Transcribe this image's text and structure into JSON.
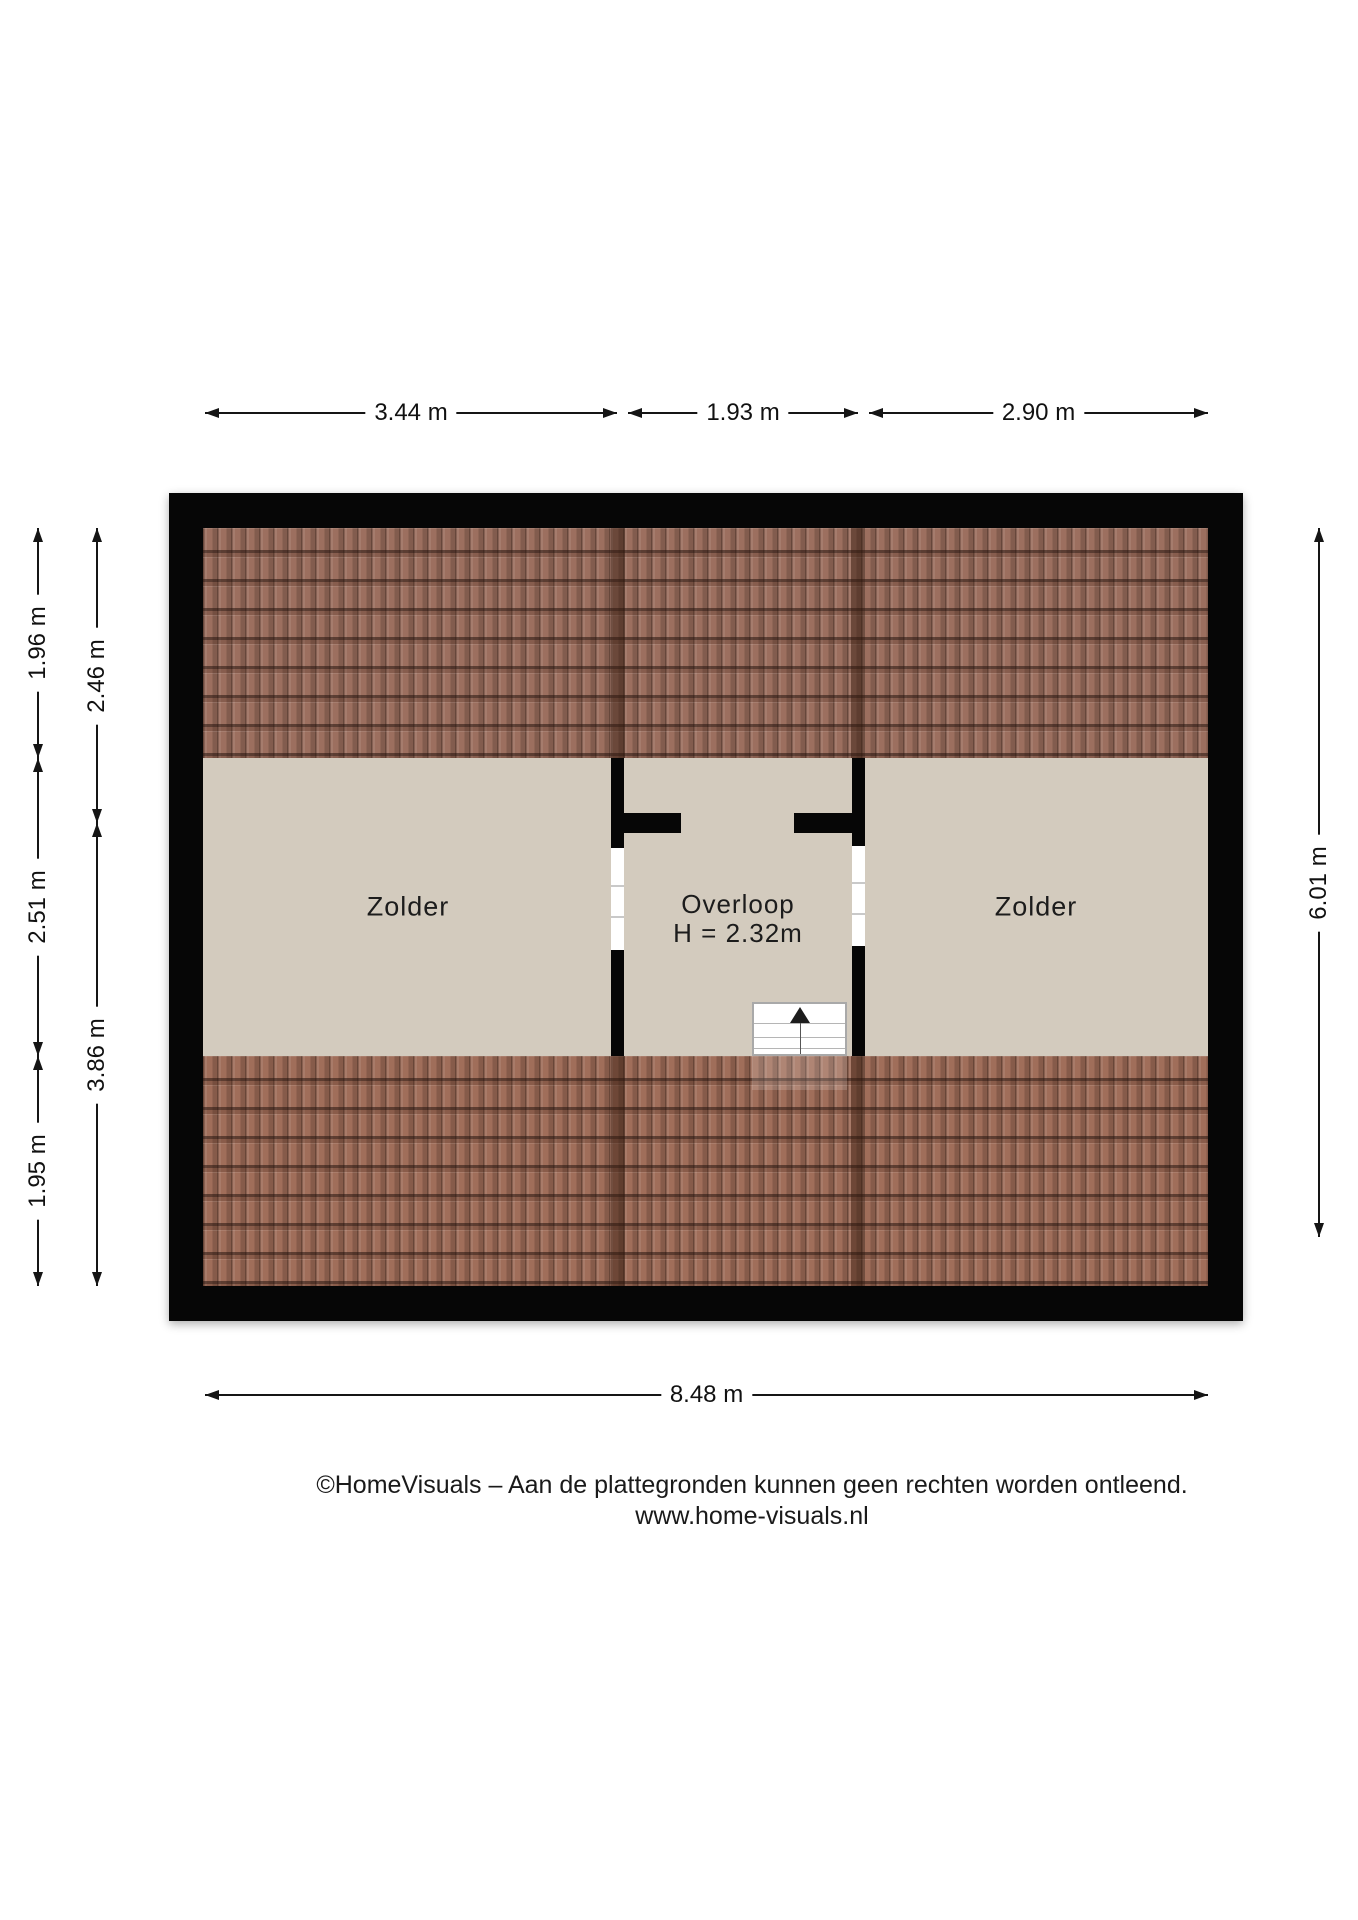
{
  "plan": {
    "type": "attic-floorplan",
    "rooms": {
      "zolder_left": {
        "label": "Zolder"
      },
      "overloop": {
        "label": "Overloop",
        "height_note": "H = 2.32m"
      },
      "zolder_right": {
        "label": "Zolder"
      }
    },
    "colors": {
      "wall": "#060606",
      "floor": "#d3cbbe",
      "roof_tile_top": "#9c6f5f",
      "roof_tile_bottom": "#a06e5a",
      "dimension_line": "#151515",
      "background": "#ffffff"
    }
  },
  "dimensions": {
    "top": [
      {
        "label": "3.44 m"
      },
      {
        "label": "1.93 m"
      },
      {
        "label": "2.90 m"
      }
    ],
    "left_outer": [
      {
        "label": "1.96 m"
      },
      {
        "label": "2.51 m"
      },
      {
        "label": "1.95 m"
      }
    ],
    "left_inner": [
      {
        "label": "2.46 m"
      },
      {
        "label": "3.86 m"
      }
    ],
    "right": [
      {
        "label": "6.01 m"
      }
    ],
    "bottom": [
      {
        "label": "8.48 m"
      }
    ]
  },
  "footer": {
    "copyright": "©HomeVisuals – Aan de plattegronden kunnen geen rechten worden ontleend.",
    "website": "www.home-visuals.nl"
  }
}
